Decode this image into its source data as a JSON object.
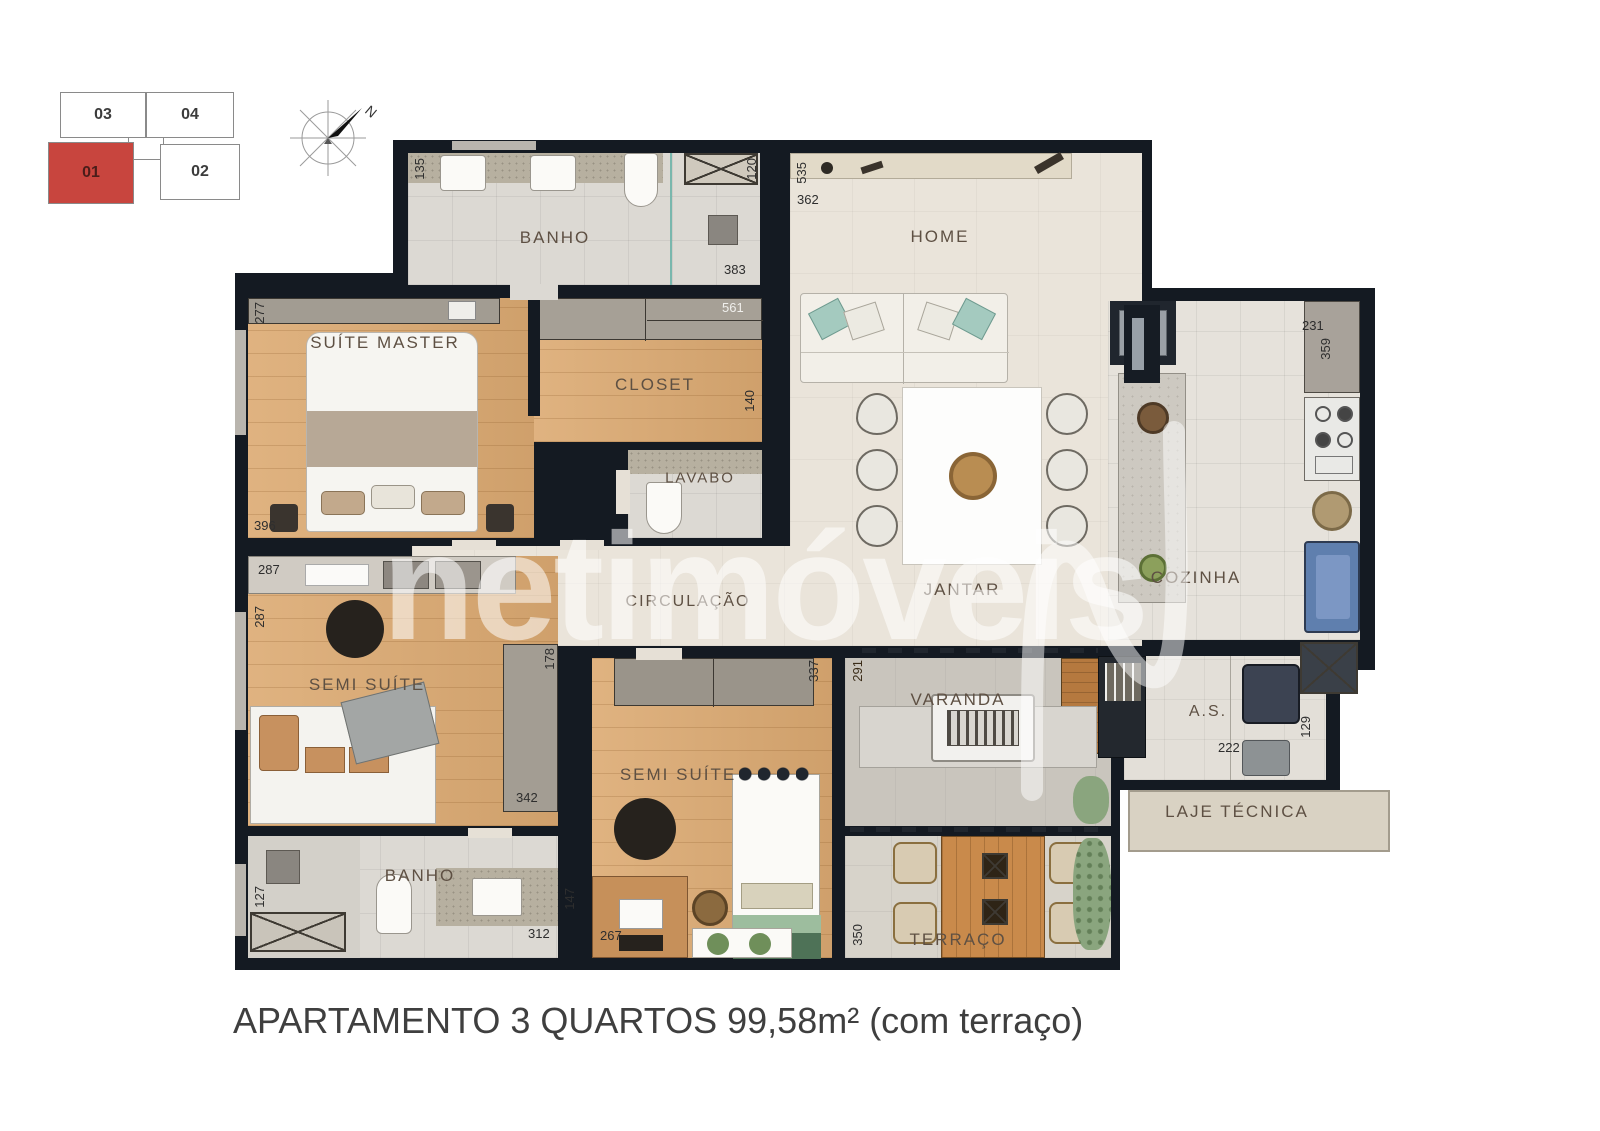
{
  "title": "APARTAMENTO 3 QUARTOS 99,58m² (com terraço)",
  "watermark": "netimóveis",
  "compass_north": "N",
  "key_plan": {
    "unit_03": "03",
    "unit_04": "04",
    "unit_01": "01",
    "unit_02": "02",
    "highlight_color": "#c8453e"
  },
  "rooms": {
    "banho_suite": "BANHO",
    "home": "HOME",
    "suite_master": "SUÍTE MASTER",
    "closet": "CLOSET",
    "lavabo": "LAVABO",
    "circulacao": "CIRCULAÇÃO",
    "jantar": "JANTAR",
    "cozinha": "COZINHA",
    "semi_suite_1": "SEMI SUÍTE",
    "semi_suite_2": "SEMI SUÍTE",
    "varanda": "VARANDA",
    "area_servico": "A.S.",
    "laje_tecnica": "LAJE TÉCNICA",
    "banho_social": "BANHO",
    "terraco": "TERRAÇO"
  },
  "dims": {
    "banho_left": "135",
    "banho_right": "120",
    "banho_width": "383",
    "closet_width": "561",
    "home_left": "535",
    "home_width": "362",
    "cozinha_top": "231",
    "cozinha_side": "359",
    "suite_left": "277",
    "suite_width": "396",
    "semi1_top": "287",
    "semi1_left": "287",
    "semi1_right": "178",
    "semi1_width": "342",
    "semi2_side": "337",
    "closet_side": "140",
    "semi2_width": "267",
    "varanda_side": "291",
    "as_width": "222",
    "as_side": "129",
    "banho2_left": "127",
    "banho2_width": "312",
    "banho2_side": "147",
    "terraco_left": "350"
  },
  "colors": {
    "wall": "#141a22",
    "wood_floor": "#dcaa72",
    "tile_floor": "#dcd9d3",
    "highlight_unit": "#c8453e"
  }
}
